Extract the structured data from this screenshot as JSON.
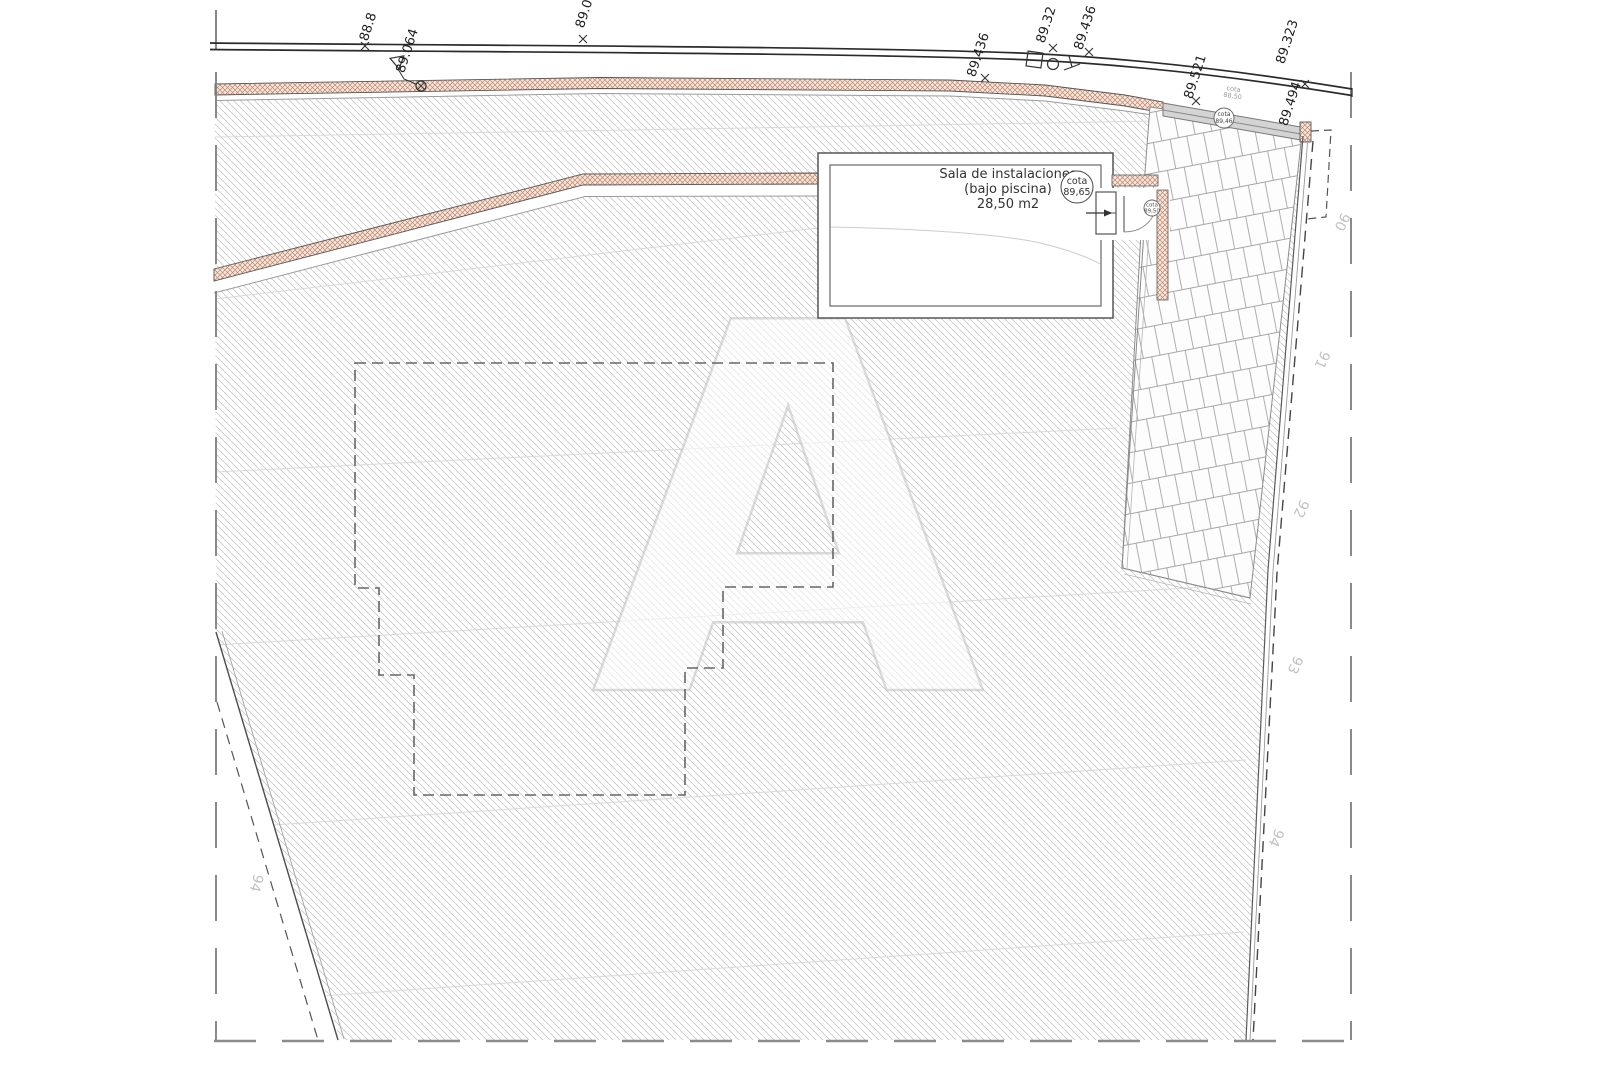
{
  "plan": {
    "room": {
      "name_line1": "Sala de instalaciones",
      "name_line2": "(bajo piscina)",
      "area": "28,50 m2"
    },
    "cotas": {
      "room_circle": {
        "label": "cota",
        "value": "89,65"
      },
      "door_circle": {
        "label": "cota",
        "value": "89,50"
      },
      "driveway_circle": {
        "label": "cota",
        "value": "89,46"
      },
      "driveway_note": {
        "label": "cota",
        "value": "88,50"
      }
    },
    "elevation_marks": [
      {
        "value": "88.8"
      },
      {
        "value": "89.0"
      },
      {
        "value": "89.064"
      },
      {
        "value": "89.436"
      },
      {
        "value": "89.32"
      },
      {
        "value": "89.436"
      },
      {
        "value": "89.521"
      },
      {
        "value": "89.323"
      },
      {
        "value": "89.494"
      }
    ],
    "contour_labels": {
      "right": [
        "90",
        "91",
        "92",
        "93",
        "94"
      ],
      "left": [
        "94"
      ]
    },
    "watermark": "A",
    "colors": {
      "wall_hatch": "#c08468",
      "terrain_hatch": "#c9c9c9",
      "line_dark": "#2b2b2b",
      "contour_label": "#c2c2c2"
    }
  }
}
